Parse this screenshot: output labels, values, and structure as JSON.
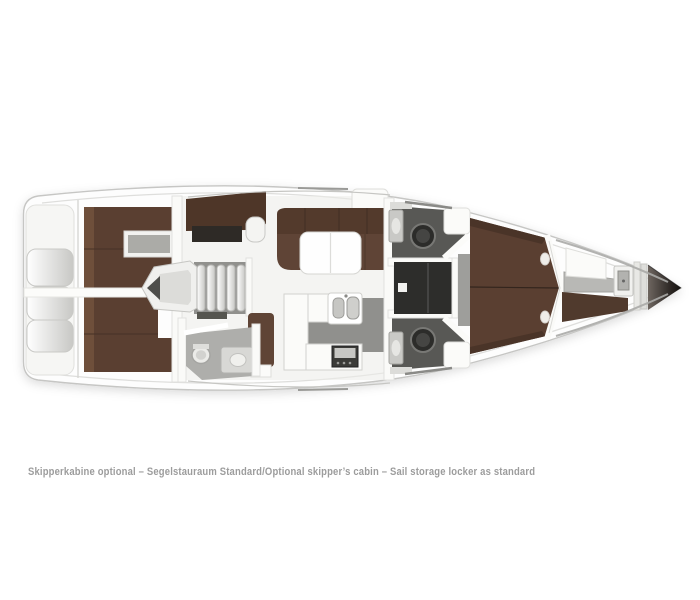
{
  "caption": "Skipperkabine optional – Segelstauraum Standard/Optional skipper’s cabin – Sail storage locker as standard",
  "colors": {
    "background": "#ffffff",
    "hull_white": "#fdfdfd",
    "hull_stroke": "#c6c6c4",
    "deck_line": "#dededc",
    "bed_brown": "#5a3f31",
    "bed_brown_light": "#73543f",
    "bed_brown_dark": "#503a2d",
    "settee_brown": "#5f4436",
    "settee_back": "#533a2c",
    "nav_desk_brown": "#4e3628",
    "head_floor": "#585855",
    "corridor": "#2d2d2b",
    "galley_floor": "#90908d",
    "aft_head_floor": "#aeaeab",
    "caption_text": "#9c9c9c"
  }
}
